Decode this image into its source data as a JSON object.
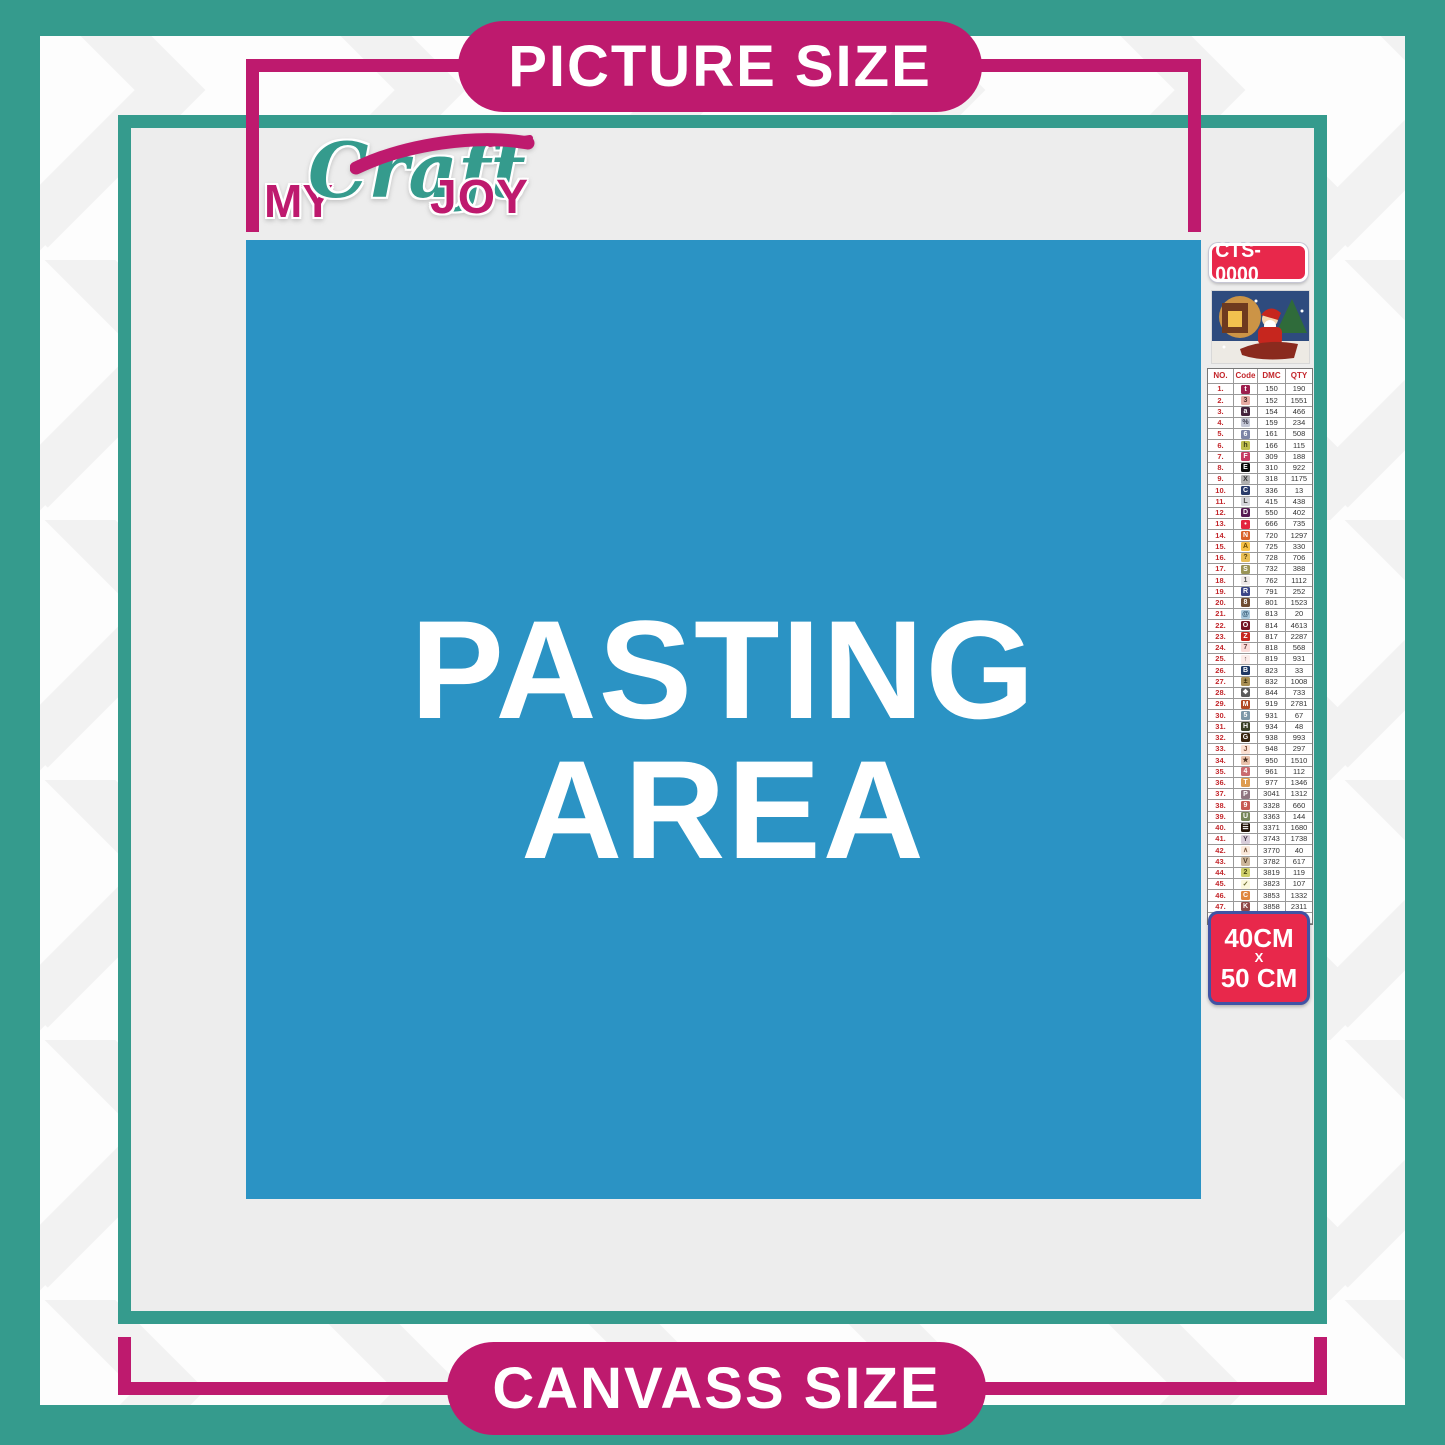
{
  "banners": {
    "picture_size": "PICTURE SIZE",
    "canvass_size": "CANVASS SIZE"
  },
  "pasting_area": {
    "line1": "PASTING",
    "line2": "AREA"
  },
  "logo": {
    "my": "MY",
    "craft": "Craft",
    "joy": "JOY"
  },
  "product": {
    "code": "CTS-0000"
  },
  "size_badge": {
    "width": "40CM",
    "separator": "X",
    "height": "50 CM"
  },
  "colors": {
    "teal": "#359B8D",
    "magenta": "#BE1A6E",
    "blue": "#2B93C4",
    "canvas_gray": "#EDEDED",
    "badge_red": "#E8284B",
    "badge_border_blue": "#4053A4",
    "table_red": "#C3262B"
  },
  "legend": {
    "headers": [
      "NO.",
      "Code",
      "DMC",
      "QTY"
    ],
    "rows": [
      {
        "no": "1.",
        "symbol": "t",
        "chip_bg": "#9E1F4E",
        "chip_fg": "#FFFFFF",
        "dmc": "150",
        "qty": "190"
      },
      {
        "no": "2.",
        "symbol": "3",
        "chip_bg": "#E7ABA3",
        "chip_fg": "#4A2B2B",
        "dmc": "152",
        "qty": "1551"
      },
      {
        "no": "3.",
        "symbol": "a",
        "chip_bg": "#43233D",
        "chip_fg": "#FFFFFF",
        "dmc": "154",
        "qty": "466"
      },
      {
        "no": "4.",
        "symbol": "%",
        "chip_bg": "#C5C8D6",
        "chip_fg": "#3A3A4A",
        "dmc": "159",
        "qty": "234"
      },
      {
        "no": "5.",
        "symbol": "6",
        "chip_bg": "#7C84A6",
        "chip_fg": "#FFFFFF",
        "dmc": "161",
        "qty": "508"
      },
      {
        "no": "6.",
        "symbol": "h",
        "chip_bg": "#BDBD4E",
        "chip_fg": "#3D3D14",
        "dmc": "166",
        "qty": "115"
      },
      {
        "no": "7.",
        "symbol": "F",
        "chip_bg": "#C53A62",
        "chip_fg": "#FFFFFF",
        "dmc": "309",
        "qty": "188"
      },
      {
        "no": "8.",
        "symbol": "E",
        "chip_bg": "#0A0A0A",
        "chip_fg": "#FFFFFF",
        "dmc": "310",
        "qty": "922"
      },
      {
        "no": "9.",
        "symbol": "X",
        "chip_bg": "#B2B2B2",
        "chip_fg": "#333333",
        "dmc": "318",
        "qty": "1175"
      },
      {
        "no": "10.",
        "symbol": "C",
        "chip_bg": "#2B3C6B",
        "chip_fg": "#FFFFFF",
        "dmc": "336",
        "qty": "13"
      },
      {
        "no": "11.",
        "symbol": "L",
        "chip_bg": "#D6D6DB",
        "chip_fg": "#444444",
        "dmc": "415",
        "qty": "438"
      },
      {
        "no": "12.",
        "symbol": "D",
        "chip_bg": "#551A52",
        "chip_fg": "#FFFFFF",
        "dmc": "550",
        "qty": "402"
      },
      {
        "no": "13.",
        "symbol": "•",
        "chip_bg": "#E3253F",
        "chip_fg": "#FFFFFF",
        "dmc": "666",
        "qty": "735"
      },
      {
        "no": "14.",
        "symbol": "N",
        "chip_bg": "#D9622B",
        "chip_fg": "#FFFFFF",
        "dmc": "720",
        "qty": "1297"
      },
      {
        "no": "15.",
        "symbol": "A",
        "chip_bg": "#F7C146",
        "chip_fg": "#6B4A00",
        "dmc": "725",
        "qty": "330"
      },
      {
        "no": "16.",
        "symbol": "?",
        "chip_bg": "#E8BE55",
        "chip_fg": "#5C430A",
        "dmc": "728",
        "qty": "706"
      },
      {
        "no": "17.",
        "symbol": "S",
        "chip_bg": "#9A9456",
        "chip_fg": "#FFFFFF",
        "dmc": "732",
        "qty": "388"
      },
      {
        "no": "18.",
        "symbol": "1",
        "chip_bg": "#EFE9E9",
        "chip_fg": "#555555",
        "dmc": "762",
        "qty": "1112"
      },
      {
        "no": "19.",
        "symbol": "R",
        "chip_bg": "#3C4687",
        "chip_fg": "#FFFFFF",
        "dmc": "791",
        "qty": "252"
      },
      {
        "no": "20.",
        "symbol": "8",
        "chip_bg": "#6E4C31",
        "chip_fg": "#FFFFFF",
        "dmc": "801",
        "qty": "1523"
      },
      {
        "no": "21.",
        "symbol": "@",
        "chip_bg": "#A9C8DC",
        "chip_fg": "#29506B",
        "dmc": "813",
        "qty": "20"
      },
      {
        "no": "22.",
        "symbol": "O",
        "chip_bg": "#751523",
        "chip_fg": "#FFFFFF",
        "dmc": "814",
        "qty": "4613"
      },
      {
        "no": "23.",
        "symbol": "Z",
        "chip_bg": "#C6261E",
        "chip_fg": "#FFFFFF",
        "dmc": "817",
        "qty": "2287"
      },
      {
        "no": "24.",
        "symbol": "7",
        "chip_bg": "#FBDCD9",
        "chip_fg": "#6B4040",
        "dmc": "818",
        "qty": "568"
      },
      {
        "no": "25.",
        "symbol": "↑",
        "chip_bg": "#FCEDEA",
        "chip_fg": "#6B5050",
        "dmc": "819",
        "qty": "931"
      },
      {
        "no": "26.",
        "symbol": "B",
        "chip_bg": "#1F3864",
        "chip_fg": "#FFFFFF",
        "dmc": "823",
        "qty": "33"
      },
      {
        "no": "27.",
        "symbol": "±",
        "chip_bg": "#A98F53",
        "chip_fg": "#2E2506",
        "dmc": "832",
        "qty": "1008"
      },
      {
        "no": "28.",
        "symbol": "❖",
        "chip_bg": "#5A5A5A",
        "chip_fg": "#FFFFFF",
        "dmc": "844",
        "qty": "733"
      },
      {
        "no": "29.",
        "symbol": "M",
        "chip_bg": "#B24A26",
        "chip_fg": "#FFFFFF",
        "dmc": "919",
        "qty": "2781"
      },
      {
        "no": "30.",
        "symbol": "5",
        "chip_bg": "#7C97A8",
        "chip_fg": "#FFFFFF",
        "dmc": "931",
        "qty": "67"
      },
      {
        "no": "31.",
        "symbol": "H",
        "chip_bg": "#3A4027",
        "chip_fg": "#FFFFFF",
        "dmc": "934",
        "qty": "48"
      },
      {
        "no": "32.",
        "symbol": "G",
        "chip_bg": "#39250F",
        "chip_fg": "#FFFFFF",
        "dmc": "938",
        "qty": "993"
      },
      {
        "no": "33.",
        "symbol": "J",
        "chip_bg": "#FBE2D4",
        "chip_fg": "#7A4A33",
        "dmc": "948",
        "qty": "297"
      },
      {
        "no": "34.",
        "symbol": "★",
        "chip_bg": "#EAC3AC",
        "chip_fg": "#4A3020",
        "dmc": "950",
        "qty": "1510"
      },
      {
        "no": "35.",
        "symbol": "4",
        "chip_bg": "#C96B70",
        "chip_fg": "#FFFFFF",
        "dmc": "961",
        "qty": "112"
      },
      {
        "no": "36.",
        "symbol": "T",
        "chip_bg": "#DE9C4F",
        "chip_fg": "#FFFFFF",
        "dmc": "977",
        "qty": "1346"
      },
      {
        "no": "37.",
        "symbol": "P",
        "chip_bg": "#8F7580",
        "chip_fg": "#FFFFFF",
        "dmc": "3041",
        "qty": "1312"
      },
      {
        "no": "38.",
        "symbol": "9",
        "chip_bg": "#C75B55",
        "chip_fg": "#FFFFFF",
        "dmc": "3328",
        "qty": "660"
      },
      {
        "no": "39.",
        "symbol": "U",
        "chip_bg": "#77875B",
        "chip_fg": "#FFFFFF",
        "dmc": "3363",
        "qty": "144"
      },
      {
        "no": "40.",
        "symbol": "☰",
        "chip_bg": "#221308",
        "chip_fg": "#FFFFFF",
        "dmc": "3371",
        "qty": "1680"
      },
      {
        "no": "41.",
        "symbol": "Y",
        "chip_bg": "#D9CEDA",
        "chip_fg": "#4A3D4D",
        "dmc": "3743",
        "qty": "1738"
      },
      {
        "no": "42.",
        "symbol": "∧",
        "chip_bg": "#FBEADC",
        "chip_fg": "#7A5A40",
        "dmc": "3770",
        "qty": "40"
      },
      {
        "no": "43.",
        "symbol": "V",
        "chip_bg": "#CDB79C",
        "chip_fg": "#4D3B26",
        "dmc": "3782",
        "qty": "617"
      },
      {
        "no": "44.",
        "symbol": "2",
        "chip_bg": "#CFD06B",
        "chip_fg": "#46470F",
        "dmc": "3819",
        "qty": "119"
      },
      {
        "no": "45.",
        "symbol": "✓",
        "chip_bg": "#FBF8DC",
        "chip_fg": "#6B6B30",
        "dmc": "3823",
        "qty": "107"
      },
      {
        "no": "46.",
        "symbol": "C",
        "chip_bg": "#E0873F",
        "chip_fg": "#FFFFFF",
        "dmc": "3853",
        "qty": "1332"
      },
      {
        "no": "47.",
        "symbol": "K",
        "chip_bg": "#8F4A49",
        "chip_fg": "#FFFFFF",
        "dmc": "3858",
        "qty": "2311"
      },
      {
        "no": "48.",
        "symbol": "A",
        "chip_bg": "#9C7D5C",
        "chip_fg": "#FFFFFF",
        "dmc": "3863",
        "qty": "1820"
      }
    ]
  }
}
